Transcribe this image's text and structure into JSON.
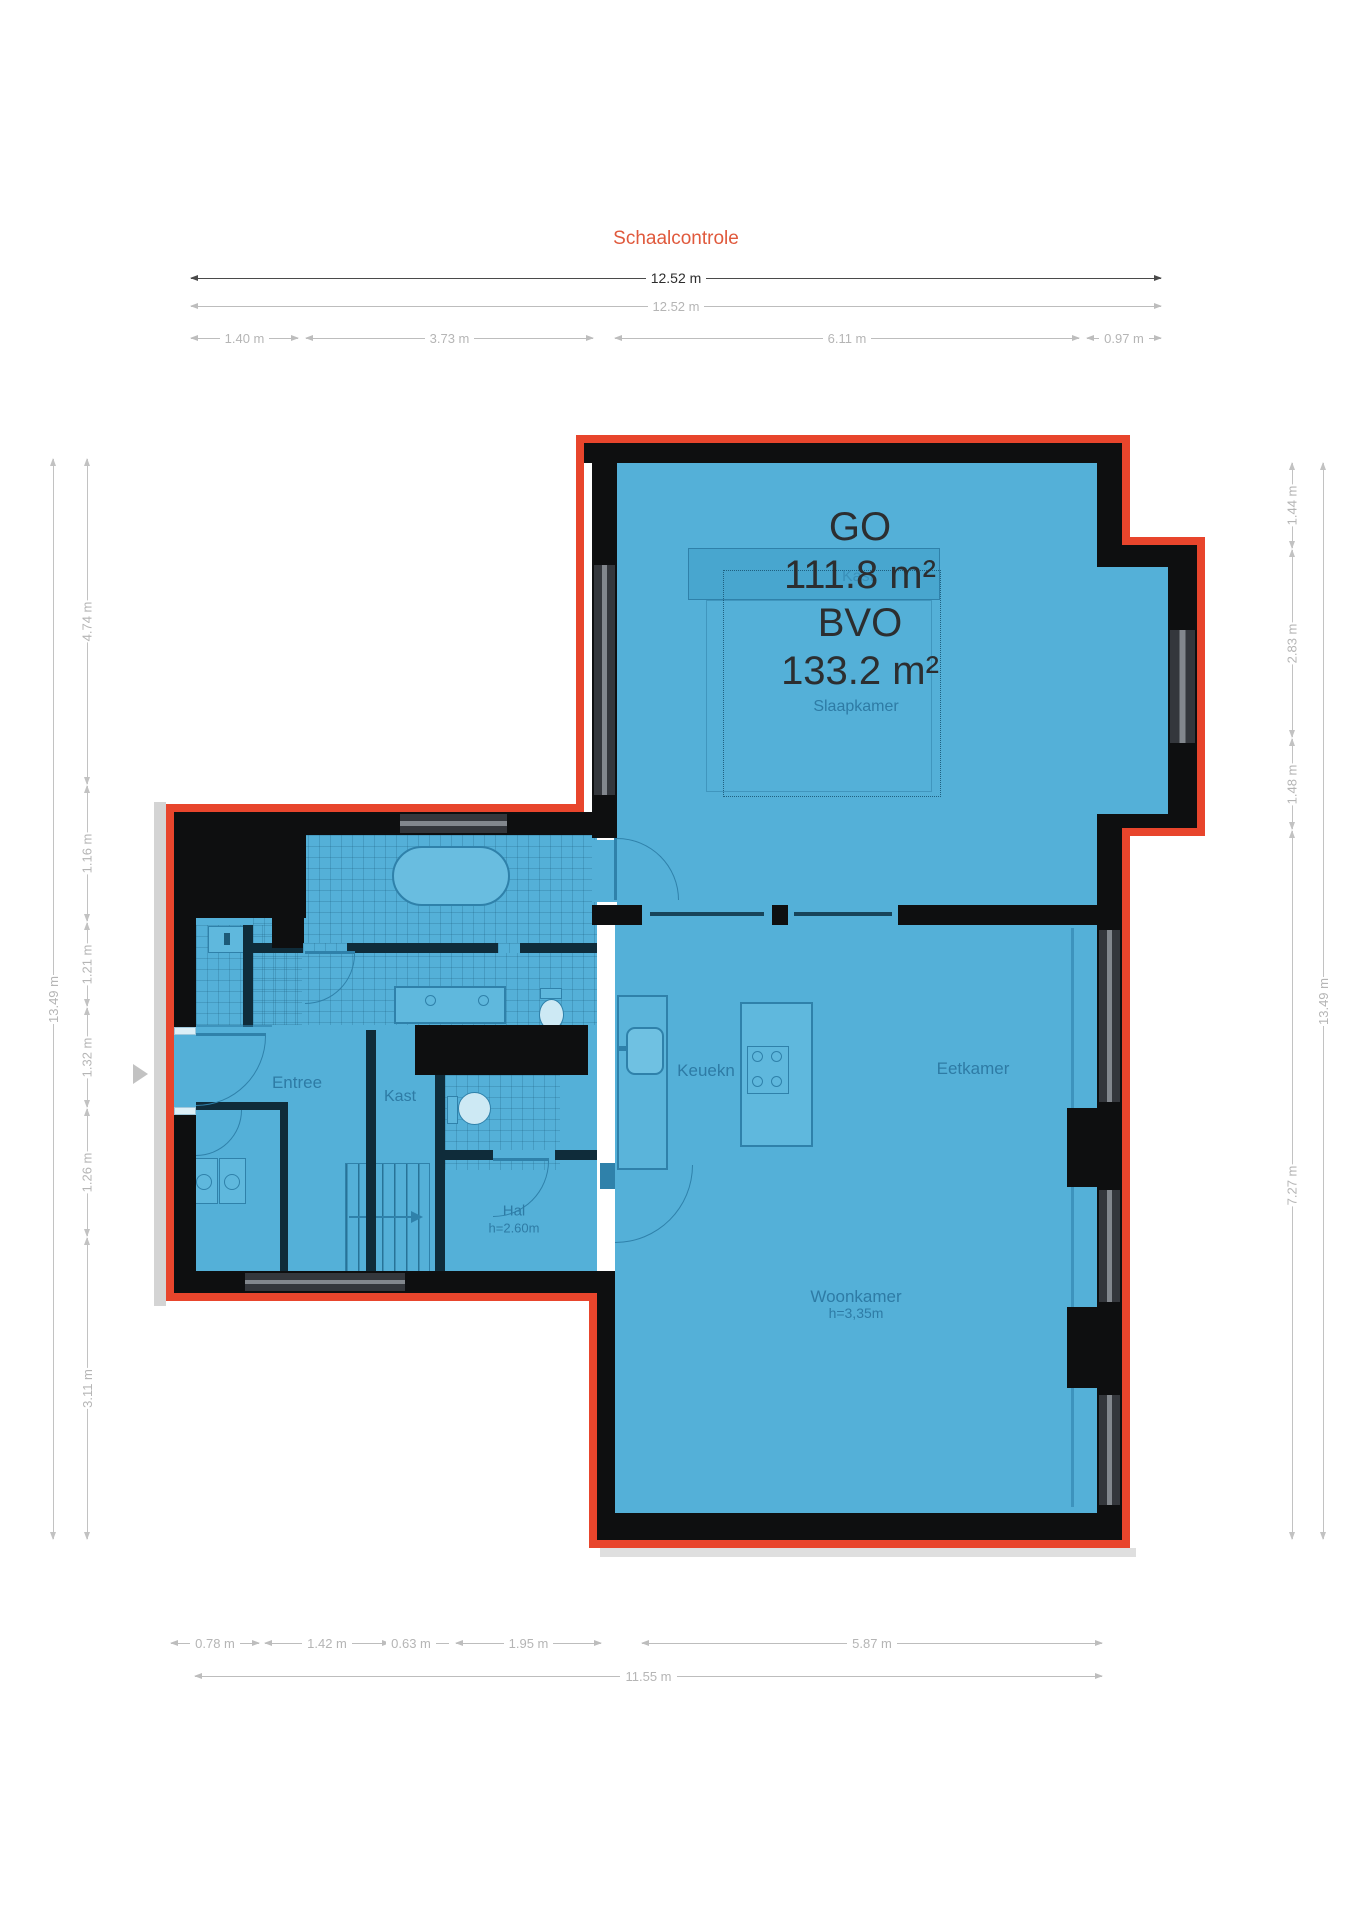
{
  "title": "Schaalcontrole",
  "colors": {
    "outline": "#e8452c",
    "fill": "#54b0d8",
    "walls": "#0e0f10",
    "title_text": "#e0593c",
    "dim_light": "#bdbdbd",
    "dim_dark": "#4a4a4a"
  },
  "dims": {
    "top": {
      "overall_dark": "12.52 m",
      "overall_light": "12.52 m",
      "segments": [
        "1.40 m",
        "3.73 m",
        "6.11 m",
        "0.97 m"
      ]
    },
    "left": {
      "overall": "13.49 m",
      "segments": [
        "4.74 m",
        "1.16 m",
        "1.21 m",
        "1.32 m",
        "1.26 m",
        "3.11 m"
      ]
    },
    "right": {
      "overall": "13.49 m",
      "segments": [
        "1.44 m",
        "2.83 m",
        "1.48 m",
        "7.27 m"
      ]
    },
    "bottom": {
      "overall": "11.55 m",
      "segments": [
        "0.78 m",
        "1.42 m",
        "0.63 m",
        "1.95 m",
        "5.87 m"
      ]
    }
  },
  "plan": {
    "area": [
      "GO",
      "111.8 m²",
      "BVO",
      "133.2 m²"
    ],
    "rooms": {
      "slaapkamer": "Slaapkamer",
      "kast_slaapkamer": "Kast",
      "entree": "Entree",
      "kast": "Kast",
      "hal": "Hal",
      "hal_height": "h=2.60m",
      "keuken": "Keuekn",
      "eetkamer": "Eetkamer",
      "woonkamer": "Woonkamer",
      "woonkamer_height": "h=3,35m"
    }
  }
}
